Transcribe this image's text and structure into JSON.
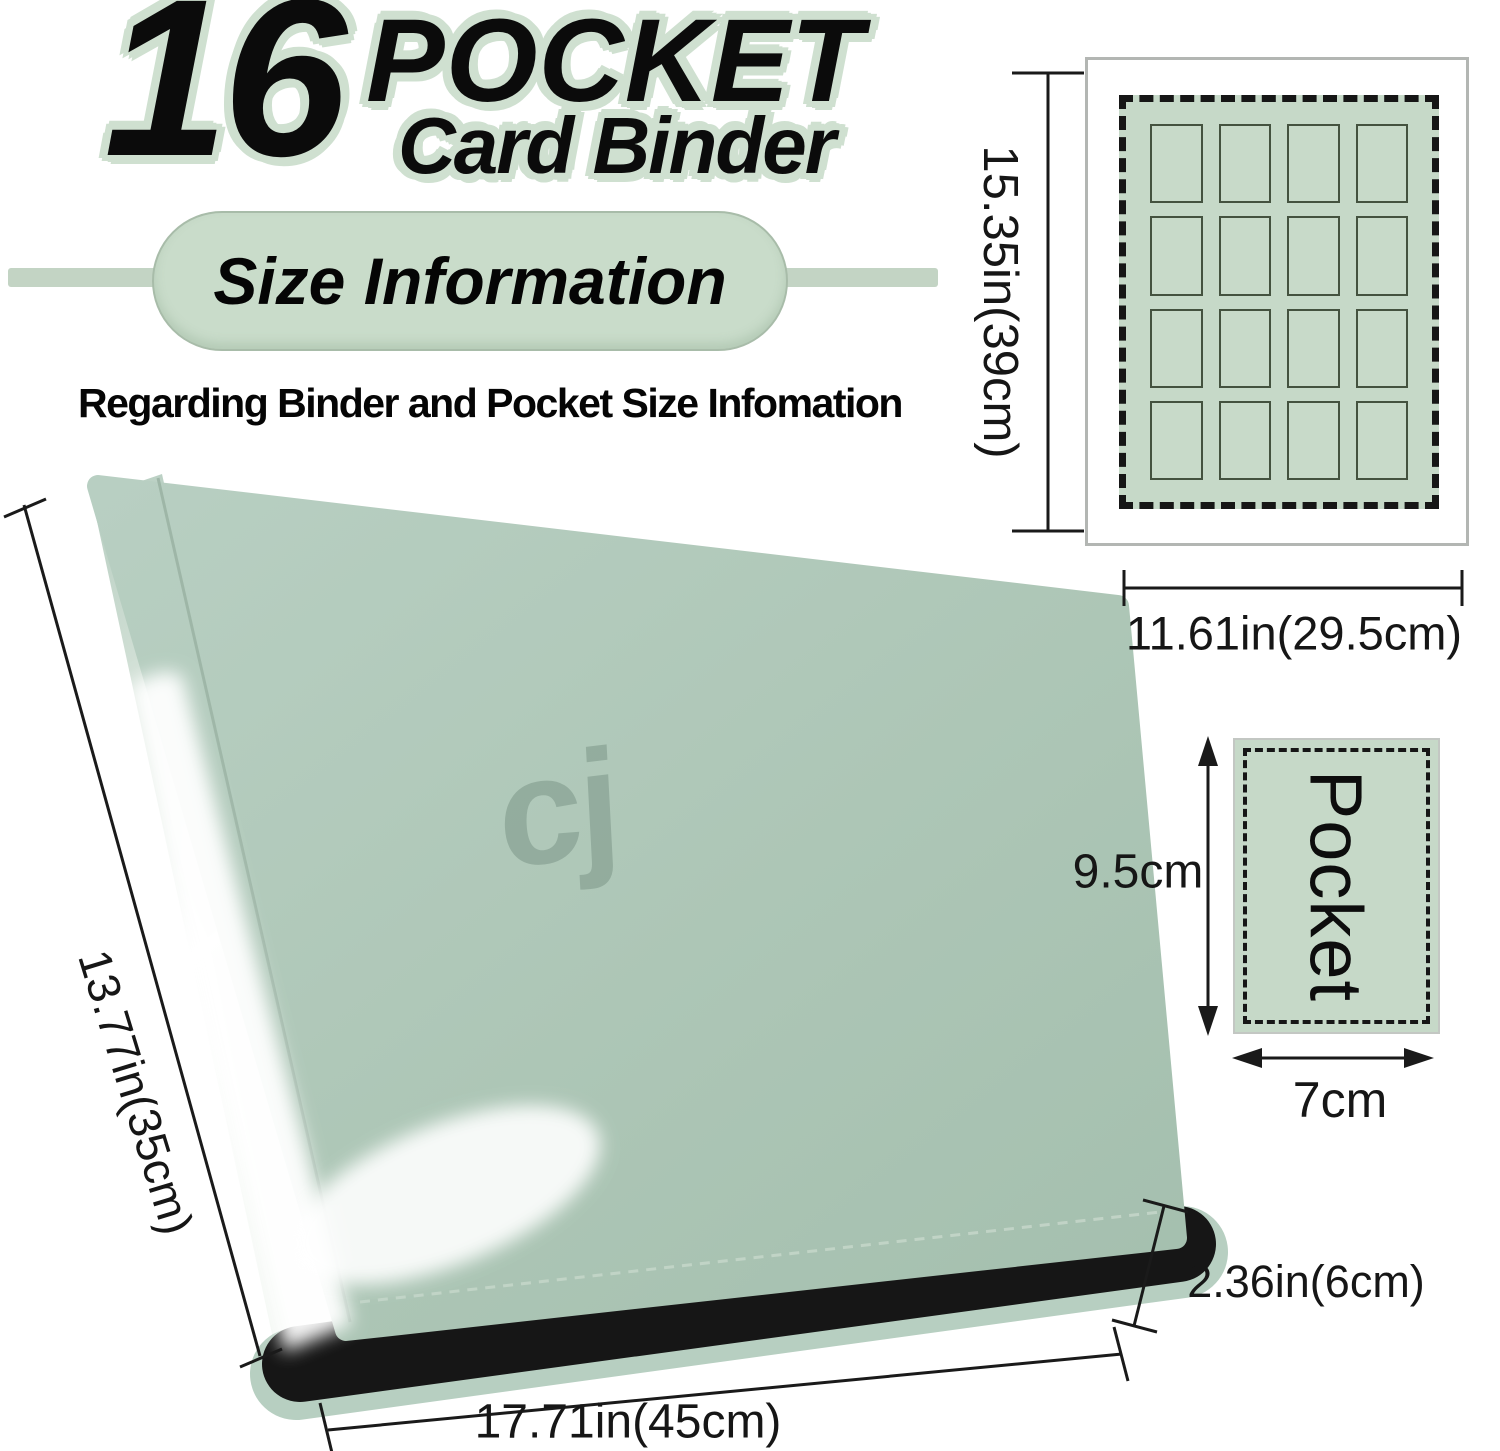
{
  "title": {
    "number": "16",
    "word1": "POCKET",
    "word2": "Card Binder"
  },
  "banner": {
    "label": "Size Information"
  },
  "subtitle": {
    "text": "Regarding Binder and Pocket Size Infomation"
  },
  "binder": {
    "logo_text": "cj",
    "spine_dim": "13.77in(35cm)",
    "width_dim": "17.71in(45cm)",
    "thickness_dim": "2.36in(6cm)"
  },
  "page_diagram": {
    "rows": 4,
    "cols": 4,
    "height_dim": "15.35in(39cm)",
    "width_dim": "11.61in(29.5cm)"
  },
  "pocket_diagram": {
    "label": "Pocket",
    "height_dim": "9.5cm",
    "width_dim": "7cm"
  },
  "colors": {
    "outline_green": "#cfe0d0",
    "pill_green": "#c9dcca",
    "band_green": "#c3d4c4",
    "diagram_green": "#c6d9c8",
    "binder_green": "#aec7b7",
    "zipper_black": "#161616",
    "page_border_gray": "#b3b6b3",
    "line_black": "#1a1a1a"
  }
}
